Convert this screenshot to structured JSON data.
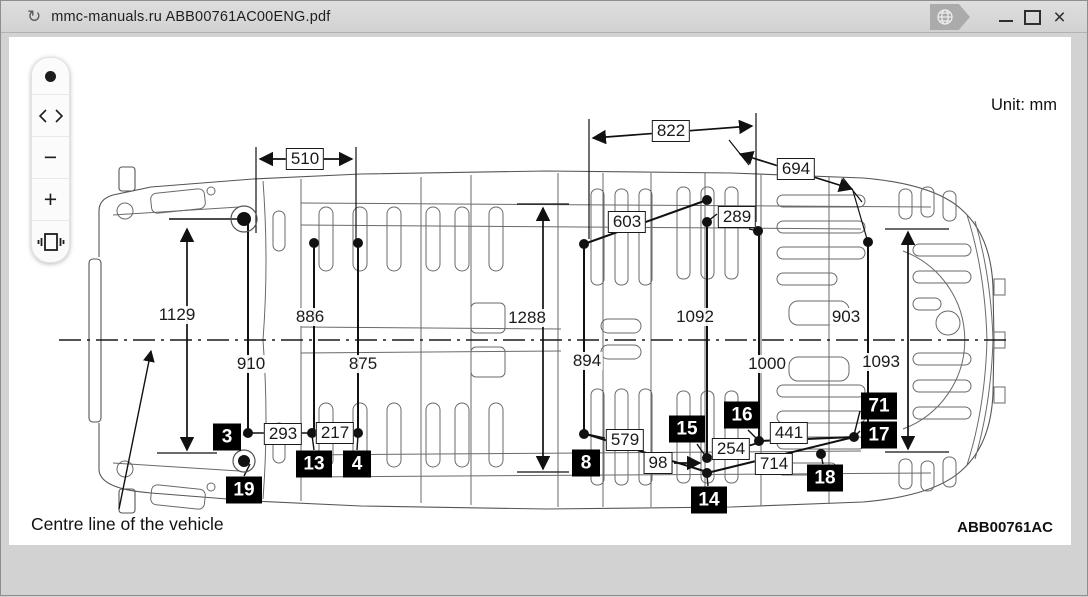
{
  "window": {
    "title": "mmc-manuals.ru ABB00761AC00ENG.pdf",
    "icons": {
      "refresh_glyph": "↻",
      "close_glyph": "×"
    }
  },
  "toolbar": {
    "marker_glyph": "●",
    "zoom_out_glyph": "−",
    "zoom_in_glyph": "+"
  },
  "diagram": {
    "notes": {
      "unit": "Unit: mm",
      "centre_line": "Centre line of the vehicle",
      "figure_code": "ABB00761AC"
    },
    "dims_boxed": {
      "d510": "510",
      "d822": "822",
      "d694": "694",
      "d603": "603",
      "d289": "289",
      "d293": "293",
      "d217": "217",
      "d579": "579",
      "d98": "98",
      "d254": "254",
      "d441": "441",
      "d714": "714"
    },
    "dims_plain": {
      "m1129": "1129",
      "m910": "910",
      "m886": "886",
      "m875": "875",
      "m1288": "1288",
      "m894": "894",
      "m1092": "1092",
      "m1000": "1000",
      "m903": "903",
      "m1093": "1093"
    },
    "callouts": {
      "c3": "3",
      "c4": "4",
      "c8": "8",
      "c13": "13",
      "c14": "14",
      "c15": "15",
      "c16": "16",
      "c17": "17",
      "c18": "18",
      "c19": "19",
      "c71": "71"
    },
    "colors": {
      "ink": "#1a1a1a",
      "bodyline": "#4d4d4d",
      "chrome": "#d2d2d2"
    }
  }
}
